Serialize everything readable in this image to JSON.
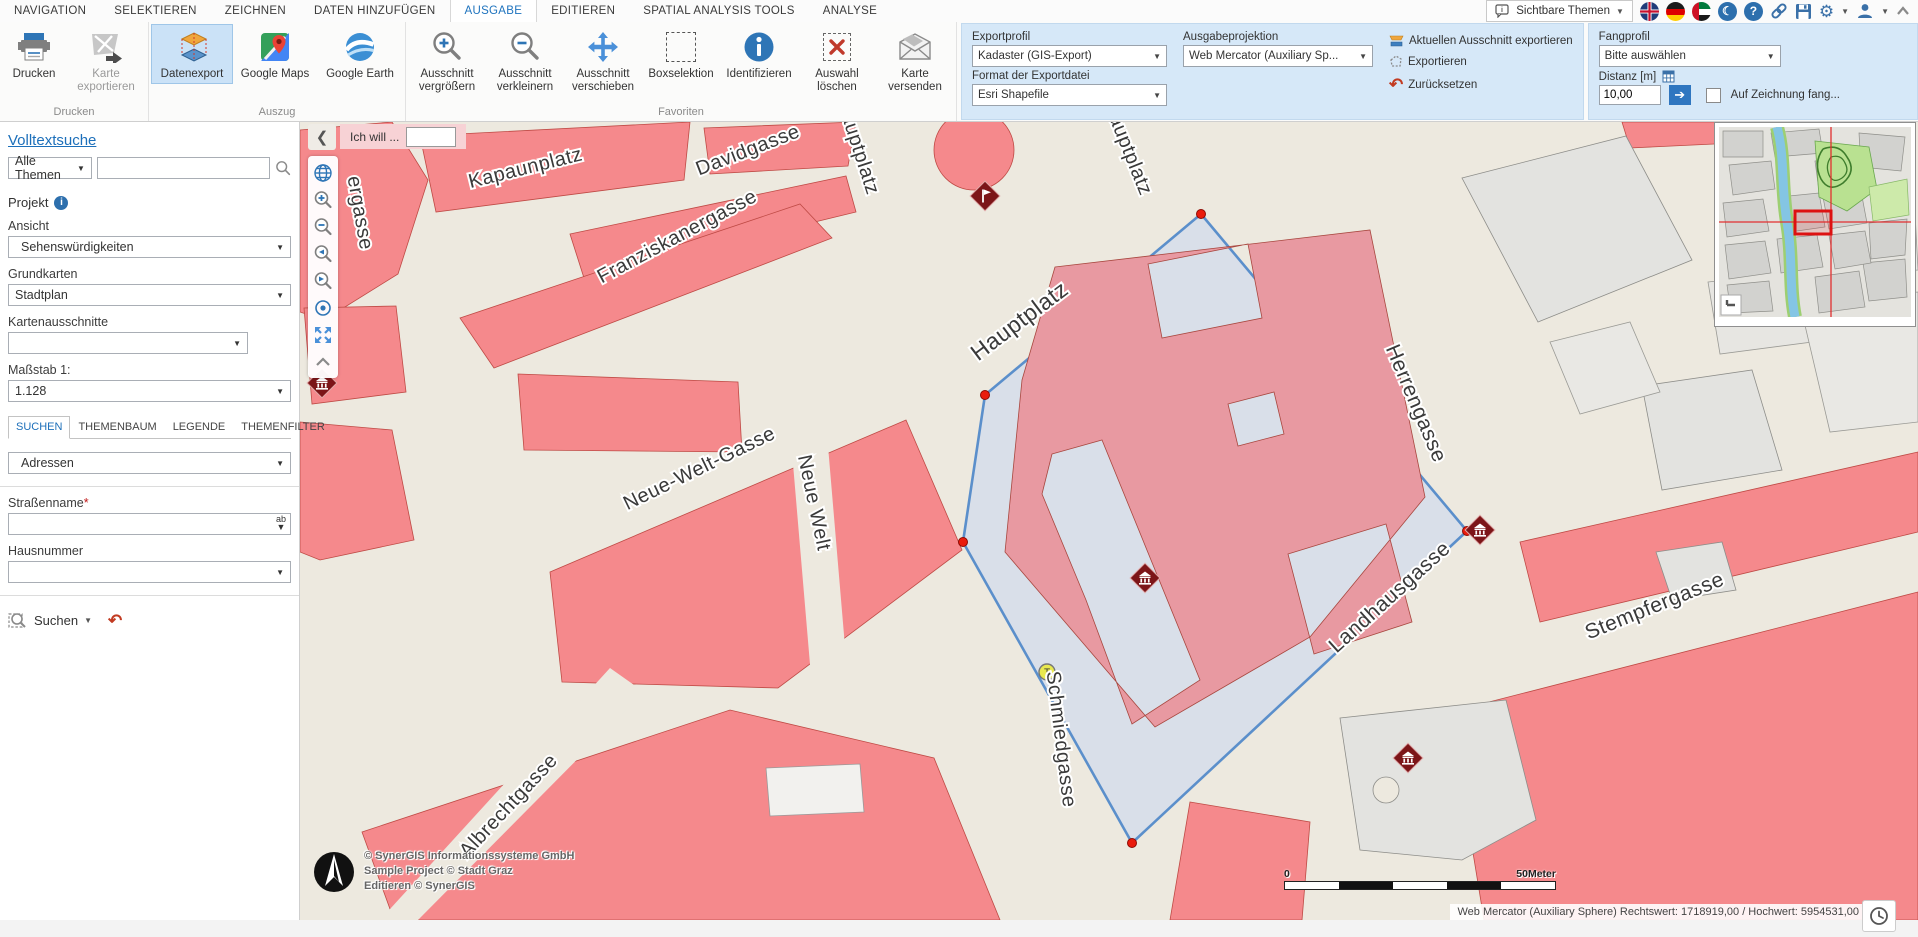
{
  "menubar": {
    "tabs": [
      {
        "label": "NAVIGATION",
        "active": false
      },
      {
        "label": "SELEKTIEREN",
        "active": false
      },
      {
        "label": "ZEICHNEN",
        "active": false
      },
      {
        "label": "DATEN HINZUFÜGEN",
        "active": false
      },
      {
        "label": "AUSGABE",
        "active": true
      },
      {
        "label": "EDITIEREN",
        "active": false
      },
      {
        "label": "SPATIAL ANALYSIS TOOLS",
        "active": false
      },
      {
        "label": "ANALYSE",
        "active": false
      }
    ],
    "visible_themes_label": "Sichtbare Themen"
  },
  "ribbon": {
    "groups": [
      {
        "label": "Drucken",
        "buttons": [
          {
            "label": "Drucken"
          },
          {
            "label": "Karte exportieren"
          }
        ]
      },
      {
        "label": "Auszug",
        "buttons": [
          {
            "label": "Datenexport"
          },
          {
            "label": "Google Maps"
          },
          {
            "label": "Google Earth"
          }
        ]
      },
      {
        "label": "Favoriten",
        "buttons": [
          {
            "label": "Ausschnitt vergrößern"
          },
          {
            "label": "Ausschnitt verkleinern"
          },
          {
            "label": "Ausschnitt verschieben"
          },
          {
            "label": "Boxselektion"
          },
          {
            "label": "Identifizieren"
          },
          {
            "label": "Auswahl löschen"
          },
          {
            "label": "Karte versenden"
          }
        ]
      }
    ],
    "export_panel": {
      "exportprofil_label": "Exportprofil",
      "exportprofil_value": "Kadaster (GIS-Export)",
      "format_label": "Format der Exportdatei",
      "format_value": "Esri Shapefile",
      "projektion_label": "Ausgabeprojektion",
      "projektion_value": "Web Mercator (Auxiliary Sp...",
      "action1": "Aktuellen Ausschnitt exportieren",
      "action2": "Exportieren",
      "action3": "Zurücksetzen"
    },
    "fang_panel": {
      "label": "Fangprofil",
      "value": "Bitte auswählen",
      "distanz_label": "Distanz [m]",
      "distanz_value": "10,00",
      "checkbox_label": "Auf Zeichnung fang..."
    }
  },
  "sidebar": {
    "title": "Volltextsuche",
    "themes_value": "Alle Themen",
    "search_placeholder": "",
    "projekt_label": "Projekt",
    "ansicht_label": "Ansicht",
    "ansicht_value": "Sehenswürdigkeiten",
    "grundkarten_label": "Grundkarten",
    "grundkarten_value": "Stadtplan",
    "kartenausschnitte_label": "Kartenausschnitte",
    "kartenausschnitte_value": "",
    "massstab_label": "Maßstab 1:",
    "massstab_value": "1.128",
    "tabs": [
      {
        "label": "SUCHEN",
        "active": true
      },
      {
        "label": "THEMENBAUM",
        "active": false
      },
      {
        "label": "LEGENDE",
        "active": false
      },
      {
        "label": "THEMENFILTER",
        "active": false
      }
    ],
    "adressen_value": "Adressen",
    "strassenname_label": "Straßenname",
    "required_mark": "*",
    "hausnummer_label": "Hausnummer",
    "suchen_label": "Suchen"
  },
  "map": {
    "ich_will_label": "Ich will ...",
    "street_labels": [
      {
        "t": "Kapaunplatz",
        "x": 227,
        "y": 52,
        "r": -14,
        "s": 20
      },
      {
        "t": "Davidgasse",
        "x": 450,
        "y": 34,
        "r": -21,
        "s": 20
      },
      {
        "t": "Franziskanergasse",
        "x": 380,
        "y": 120,
        "r": -28,
        "s": 20
      },
      {
        "t": "Hauptplatz",
        "x": 552,
        "y": 26,
        "r": 72,
        "s": 20
      },
      {
        "t": "Hauptplatz",
        "x": 822,
        "y": 28,
        "r": 68,
        "s": 20
      },
      {
        "t": "Hauptplatz",
        "x": 724,
        "y": 205,
        "r": -37,
        "s": 23
      },
      {
        "t": "ergasse",
        "x": 54,
        "y": 92,
        "r": 80,
        "s": 20
      },
      {
        "t": "Neue-Welt-Gasse",
        "x": 402,
        "y": 352,
        "r": -26,
        "s": 20
      },
      {
        "t": "Neue Welt",
        "x": 508,
        "y": 382,
        "r": 78,
        "s": 20
      },
      {
        "t": "Herrengasse",
        "x": 1110,
        "y": 284,
        "r": 67,
        "s": 21
      },
      {
        "t": "Landhausgasse",
        "x": 1094,
        "y": 480,
        "r": -42,
        "s": 21
      },
      {
        "t": "Schmiedgasse",
        "x": 755,
        "y": 618,
        "r": 83,
        "s": 20
      },
      {
        "t": "Stempfergasse",
        "x": 1357,
        "y": 490,
        "r": -22,
        "s": 21
      },
      {
        "t": "Albrechtgasse",
        "x": 213,
        "y": 688,
        "r": -47,
        "s": 20
      }
    ],
    "credits_line1": "© SynerGIS Informationssysteme GmbH",
    "credits_line2": "Sample Project © Stadt Graz",
    "credits_line3": "Editieren © SynerGIS",
    "scalebar_min": "0",
    "scalebar_max": "50Meter",
    "status_text": "Web Mercator (Auxiliary Sphere) Rechtswert: 1718919,00 / Hochwert: 5954531,00"
  },
  "colors": {
    "accent": "#1e73be",
    "ribbon_panel": "#d6e8f8",
    "block_salmon": "#f5898c",
    "selection_fill": "#d8dee9",
    "selection_stroke": "#5b8fcb",
    "selected_building": "#e899a1",
    "street_beige": "#ede9df",
    "marker_red": "#7c1518",
    "vertex_red": "#ea1c0d"
  }
}
